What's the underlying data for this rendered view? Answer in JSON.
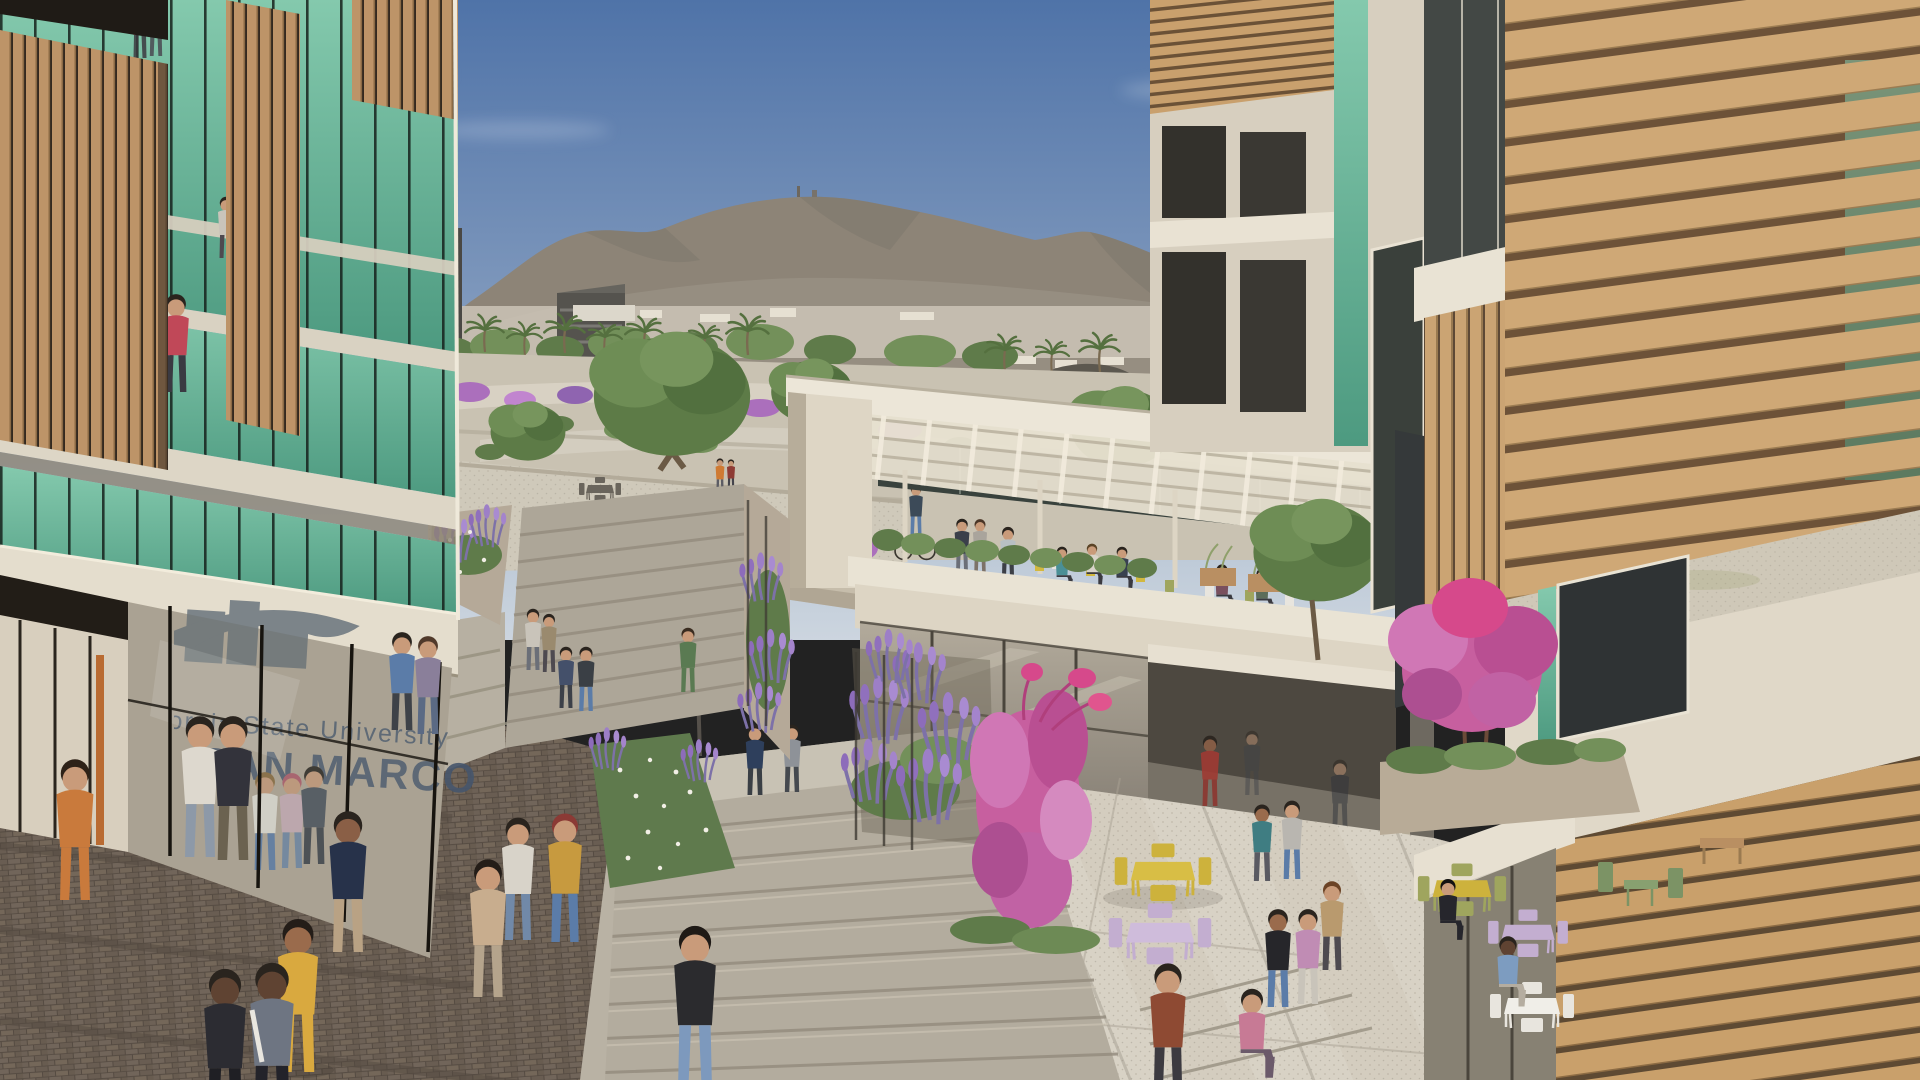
{
  "scene": {
    "type": "architectural-rendering",
    "setting": "University mixed-use campus plaza with mountain backdrop, midday clear sky",
    "signage": {
      "line1": "California State University",
      "line2": "SAN MARCOS",
      "location": "glass storefront of left residential building",
      "logo": "building-silhouette-with-swoosh mural"
    },
    "buildings": {
      "left_tower": "residential tower with vertical wood slats, green glass and concrete bands",
      "right_tower": "residential tower with angled wood louver screens and slat walls",
      "terrace_pavilion": "dining pavilion with rooftop pergola terrace and planter rail",
      "retail_base": "ground-floor retail with glass storefronts and open corner",
      "distant": [
        "dark office block",
        "domed arena hall",
        "hillside suburban housing"
      ]
    },
    "landscape": [
      "rocky mountain ridge",
      "palm trees",
      "street trees",
      "pink bougainvillea trees",
      "lavender planting beds",
      "terraced hillside gravel paths",
      "white flower bed"
    ],
    "plaza": {
      "features": [
        "central stair flights",
        "herringbone brick paving",
        "speckled terrazzo courtyard",
        "cafe seating",
        "street lamp",
        "metal railings",
        "bicycle"
      ],
      "people_count": 51,
      "cafe_table_sets": 8,
      "bicycles": 1
    },
    "palette": {
      "sky_top": "#4f73a8",
      "sky_horizon": "#ccd5df",
      "mountain": "#8d8477",
      "mountain_shadow": "#756f66",
      "foliage": "#66854e",
      "foliage_dark": "#4c6a3e",
      "bougainvillea_pink": "#c75f9f",
      "lavender_purple": "#9d7fc7",
      "wood_slat": "#bf9668",
      "slat_gap": "#3a2f24",
      "glass_teal": "#6fbc9f",
      "concrete": "#ddd6c7",
      "fascia_white": "#ece6d8",
      "paving": "#d8d2c5",
      "brick": "#6b5f53",
      "step_stone": "#b3ac9e",
      "table_yellow": "#cdb23c",
      "table_lavender": "#c3aed0",
      "chair_olive": "#9fa55e",
      "chair_green": "#7c9365",
      "table_white": "#e8e5de"
    }
  }
}
